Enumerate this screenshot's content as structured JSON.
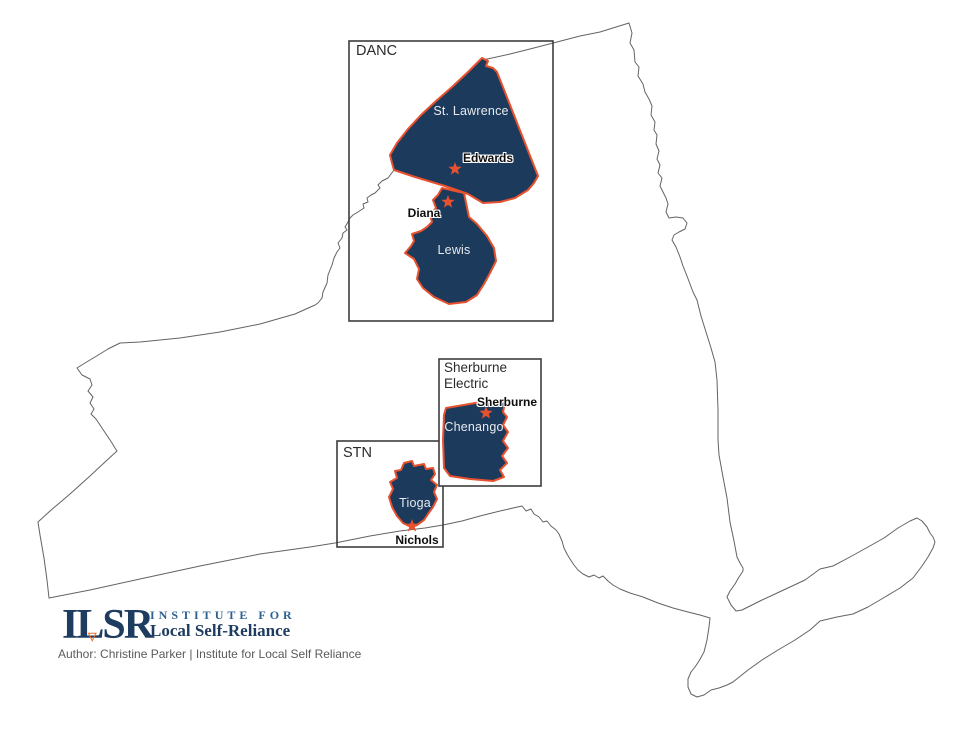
{
  "map": {
    "boxes": {
      "danc": {
        "label": "DANC"
      },
      "sherburne_electric": {
        "label_line1": "Sherburne",
        "label_line2": "Electric"
      },
      "stn": {
        "label": "STN"
      }
    },
    "counties": {
      "st_lawrence": {
        "label": "St. Lawrence"
      },
      "lewis": {
        "label": "Lewis"
      },
      "chenango": {
        "label": "Chenango"
      },
      "tioga": {
        "label": "Tioga"
      }
    },
    "towns": {
      "edwards": {
        "label": "Edwards"
      },
      "diana": {
        "label": "Diana"
      },
      "sherburne": {
        "label": "Sherburne"
      },
      "nichols": {
        "label": "Nichols"
      }
    }
  },
  "footer": {
    "logo": {
      "acronym": "ILSR",
      "triangle_glyph": "▽",
      "top_line": "INSTITUTE FOR",
      "bottom_line": "Local Self-Reliance"
    },
    "credit": "Author: Christine Parker | Institute for Local Self Reliance"
  },
  "colors": {
    "county_fill": "#1c3a5c",
    "county_stroke": "#e8512e",
    "star": "#e8512e",
    "state_outline": "#636363",
    "box_border": "#3d3d3d",
    "logo_navy": "#1d3c5f",
    "logo_blue": "#2d6191",
    "logo_triangle": "#e8732e"
  }
}
